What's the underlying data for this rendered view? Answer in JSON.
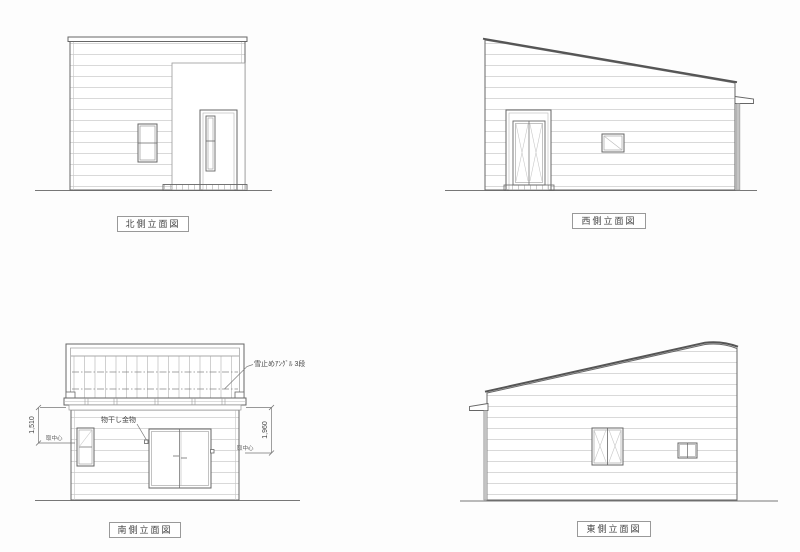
{
  "views": {
    "north": {
      "label": "北側立面図"
    },
    "west": {
      "label": "西側立面図"
    },
    "south": {
      "label": "南側立面図",
      "annotations": {
        "snow_guard": "雪止めｱﾝｸﾞﾙ 3段",
        "laundry_hook": "物干し金物"
      },
      "dimensions": {
        "left": {
          "value": "1,510",
          "note": "取中心"
        },
        "right": {
          "value": "1,960",
          "note": "取中心"
        }
      }
    },
    "east": {
      "label": "東側立面図"
    }
  },
  "colors": {
    "outline": "#666666",
    "roof_edge": "#555555",
    "siding": "#cccccc",
    "downspout": "#c4c4c4",
    "text": "#444444",
    "background": "#ffffff"
  }
}
